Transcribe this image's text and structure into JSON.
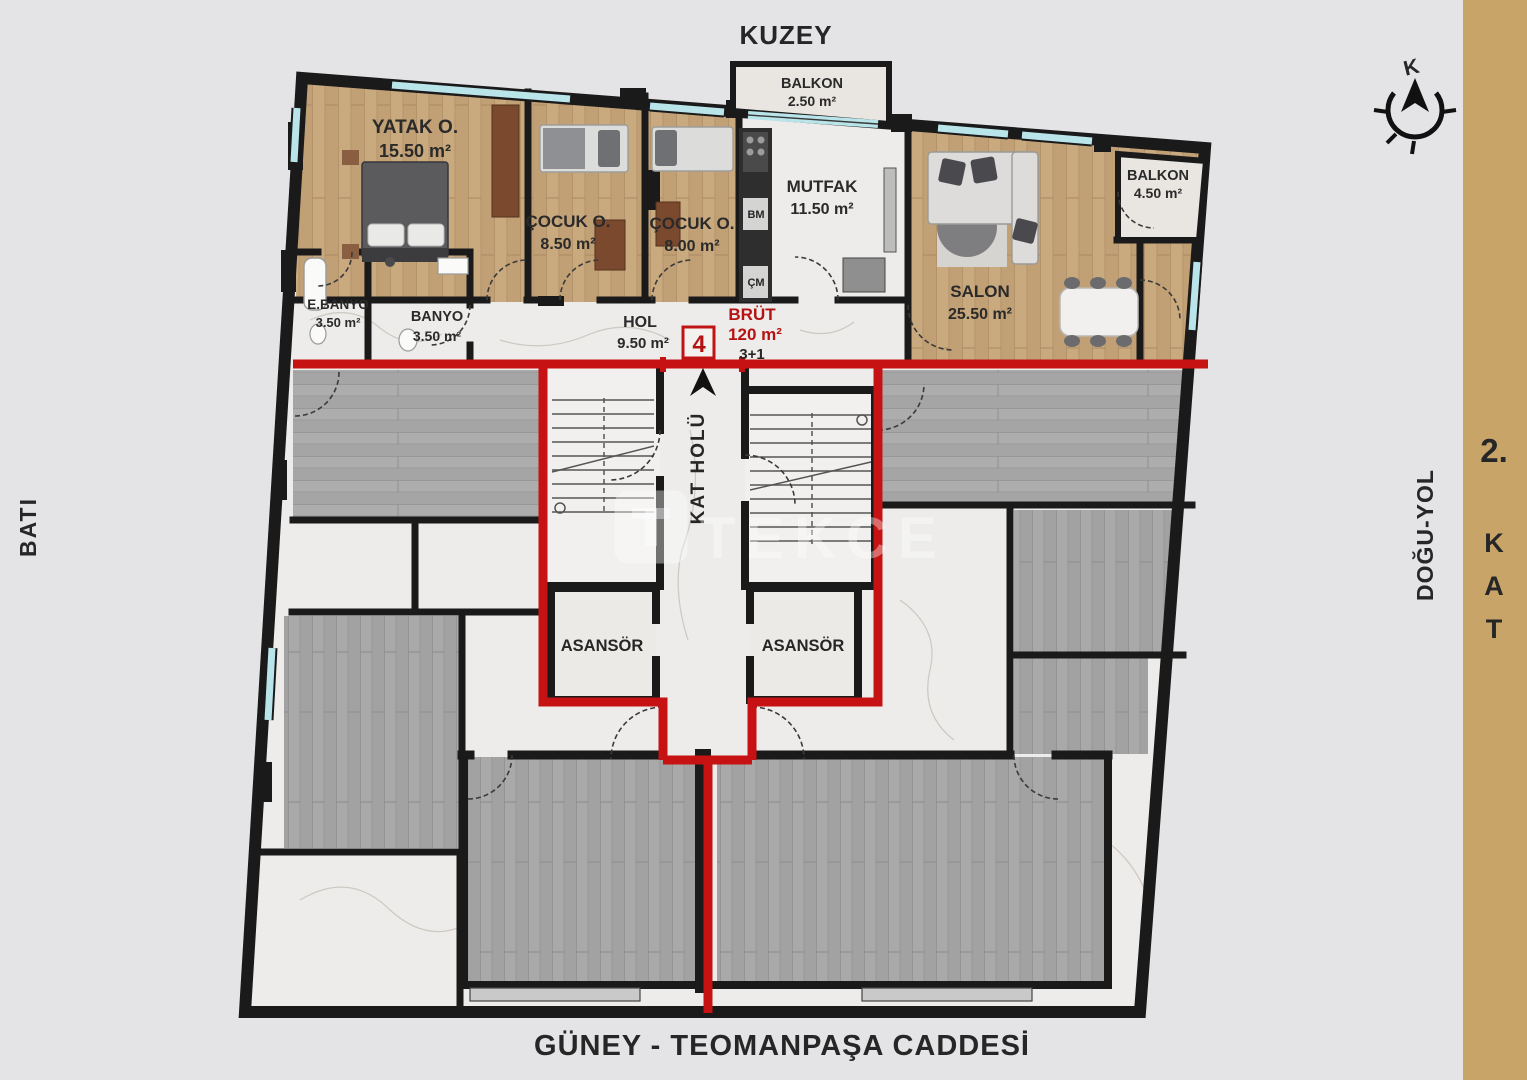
{
  "colors": {
    "background": "#e4e4e6",
    "floor_band": "#c8a469",
    "boundary_red": "#c61212",
    "wall_black": "#1a1a1a",
    "wood_unit": "#c9a97e",
    "wood_gray": "#a9a9a9",
    "marble": "#edecea",
    "window_glass": "#b9e4e9"
  },
  "directions": {
    "north": "KUZEY",
    "west": "BATI",
    "east_road": "DOĞU-YOL",
    "south_street": "GÜNEY - TEOMANPAŞA CADDESİ"
  },
  "compass": {
    "letter": "K"
  },
  "floor_badge": {
    "number": "2.",
    "letters": [
      "K",
      "A",
      "T"
    ]
  },
  "unit": {
    "badge": "4",
    "gross_label": "BRÜT",
    "gross_area": "120 m²",
    "plan_type": "3+1"
  },
  "rooms": [
    {
      "name": "YATAK O.",
      "area": "15.50 m²"
    },
    {
      "name": "ÇOCUK O.",
      "area": "8.50 m²"
    },
    {
      "name": "ÇOCUK O.",
      "area": "8.00 m²"
    },
    {
      "name": "MUTFAK",
      "area": "11.50 m²"
    },
    {
      "name": "SALON",
      "area": "25.50 m²"
    },
    {
      "name": "BALKON",
      "area": "2.50 m²"
    },
    {
      "name": "BALKON",
      "area": "4.50 m²"
    },
    {
      "name": "E.BANYO",
      "area": "3.50 m²"
    },
    {
      "name": "BANYO",
      "area": "3.50 m²"
    },
    {
      "name": "HOL",
      "area": "9.50 m²"
    }
  ],
  "core": {
    "hall": "KAT HOLÜ",
    "elevator": "ASANSÖR"
  },
  "appliances": {
    "bm": "BM",
    "cm": "ÇM"
  },
  "watermark": "TEKCE"
}
